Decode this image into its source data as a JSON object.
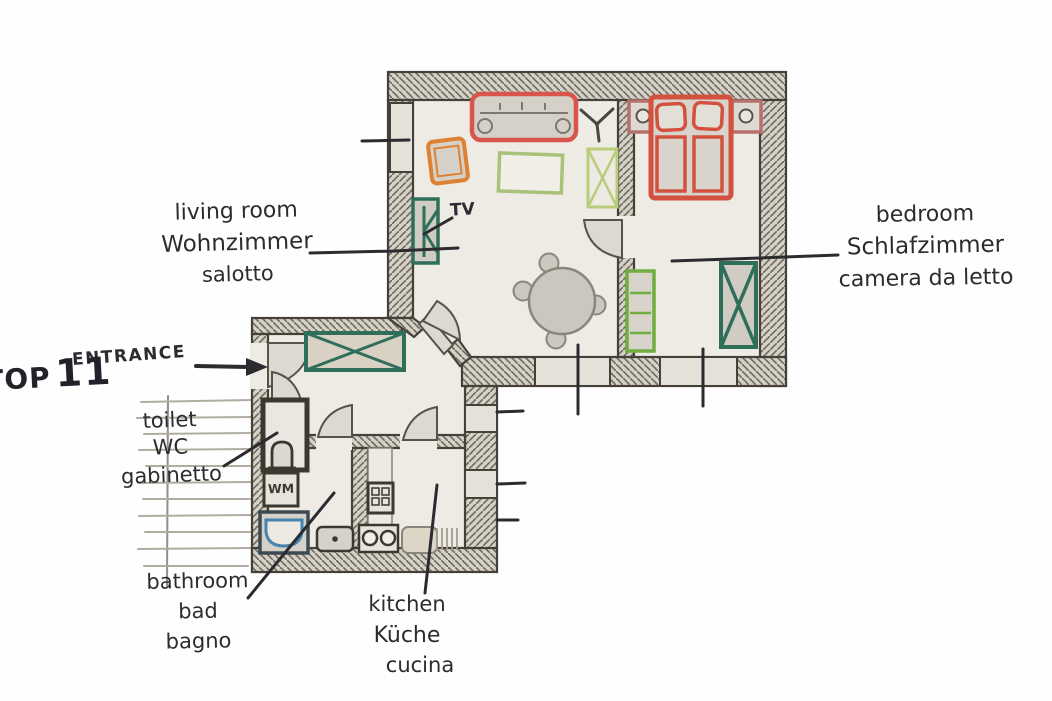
{
  "unit": {
    "name": "TOP",
    "number": "11"
  },
  "entrance_label": "ENTRANCE",
  "rooms": {
    "living_room": {
      "en": "living room",
      "de": "Wohnzimmer",
      "it": "salotto"
    },
    "bedroom": {
      "en": "bedroom",
      "de": "Schlafzimmer",
      "it": "camera da letto"
    },
    "toilet": {
      "en": "toilet",
      "de": "WC",
      "it": "gabinetto"
    },
    "bathroom": {
      "en": "bathroom",
      "de": "bad",
      "it": "bagno"
    },
    "kitchen": {
      "en": "kitchen",
      "de": "Küche",
      "it": "cucina"
    }
  },
  "annotations": {
    "tv": "TV",
    "washing_machine": "WM"
  },
  "palette": {
    "floor": "#edebe4",
    "wall_fill": "#d5d1c6",
    "wall_hatch": "#6f6a5e",
    "ink": "#2c2b30",
    "door_fill": "#dcd9d1",
    "furniture_gray": "#d5d1c8",
    "sofa_red": "#d9544b",
    "bed_red": "#d4503f",
    "nightstand_red": "#b5716b",
    "chair_orange": "#de8133",
    "coffee_table_green": "#a9c178",
    "cabinet_green": "#b9cc7a",
    "wardrobe_teal": "#2f6f5a",
    "shelf_green": "#6fae3f",
    "bathtub_blue": "#4484ad"
  }
}
